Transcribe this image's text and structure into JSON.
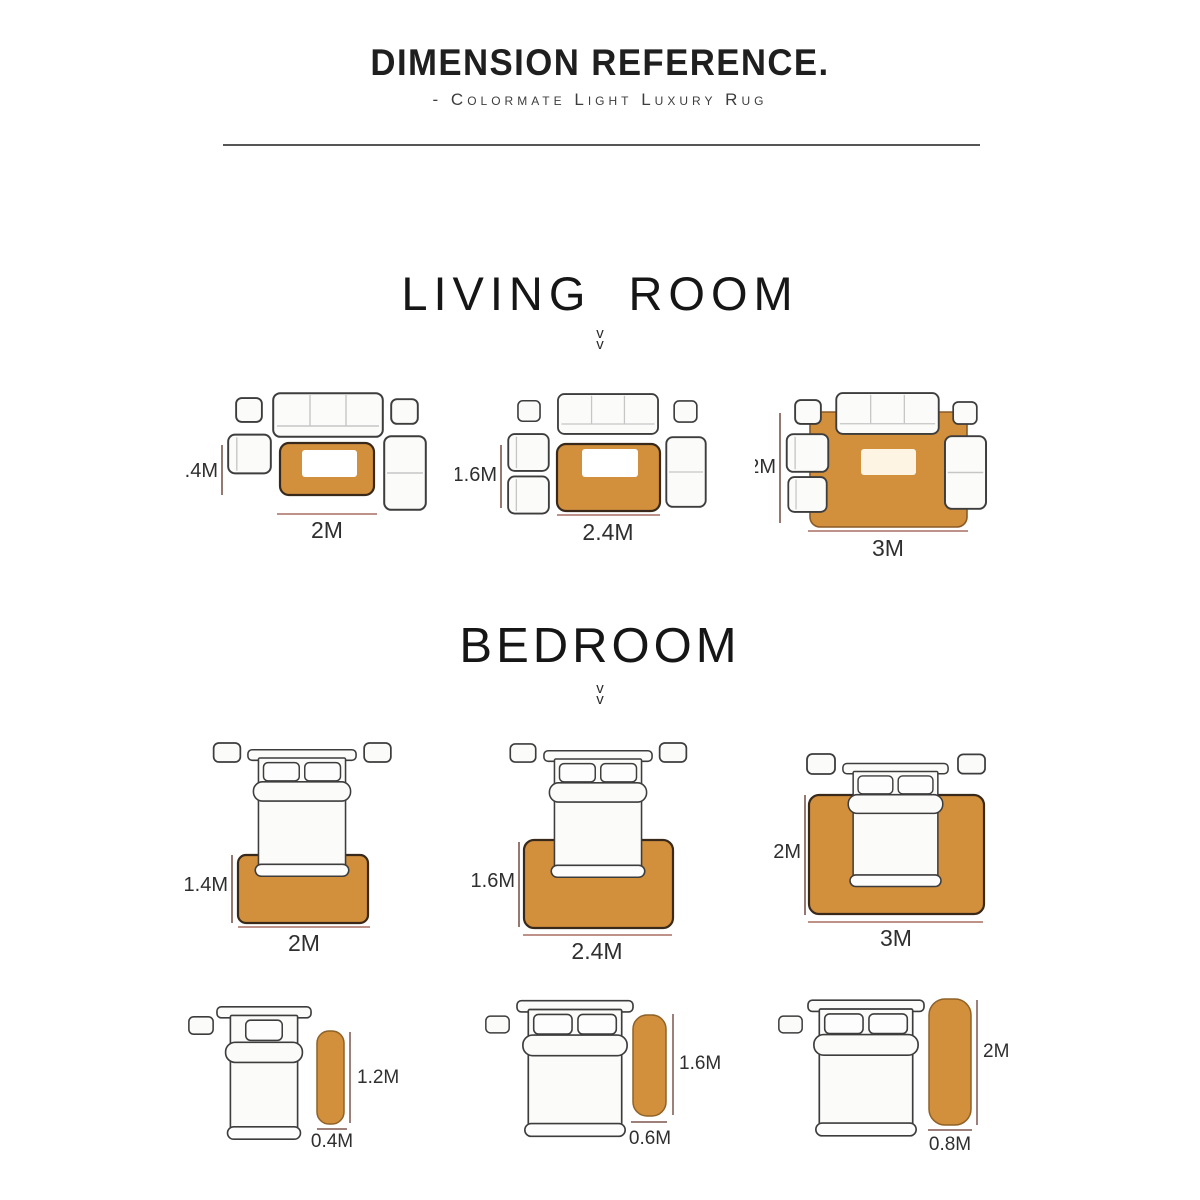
{
  "header": {
    "title": "DIMENSION REFERENCE.",
    "subtitle": "- Colormate Light Luxury Rug"
  },
  "sections": {
    "living_room": {
      "heading": "LIVING ROOM",
      "chevron": "v",
      "layouts": [
        {
          "height_label": ".4M",
          "width_label": "2M"
        },
        {
          "height_label": "1.6M",
          "width_label": "2.4M"
        },
        {
          "height_label": "2M",
          "width_label": "3M"
        }
      ]
    },
    "bedroom": {
      "heading": "BEDROOM",
      "chevron": "v",
      "layouts": [
        {
          "height_label": "1.4M",
          "width_label": "2M"
        },
        {
          "height_label": "1.6M",
          "width_label": "2.4M"
        },
        {
          "height_label": "2M",
          "width_label": "3M"
        }
      ],
      "runner_layouts": [
        {
          "height_label": "1.2M",
          "width_label": "0.4M"
        },
        {
          "height_label": "1.6M",
          "width_label": "0.6M"
        },
        {
          "height_label": "2M",
          "width_label": "0.8M"
        }
      ]
    }
  },
  "colors": {
    "rug_fill": "#d28f3c",
    "rug_border_dark": "#38291a",
    "runner_border": "#8f6228",
    "measure_line_vertical": "#7d564d",
    "measure_line_horizontal": "#a86f62",
    "furniture_stroke": "#3d3d3d",
    "divider": "#565656"
  }
}
